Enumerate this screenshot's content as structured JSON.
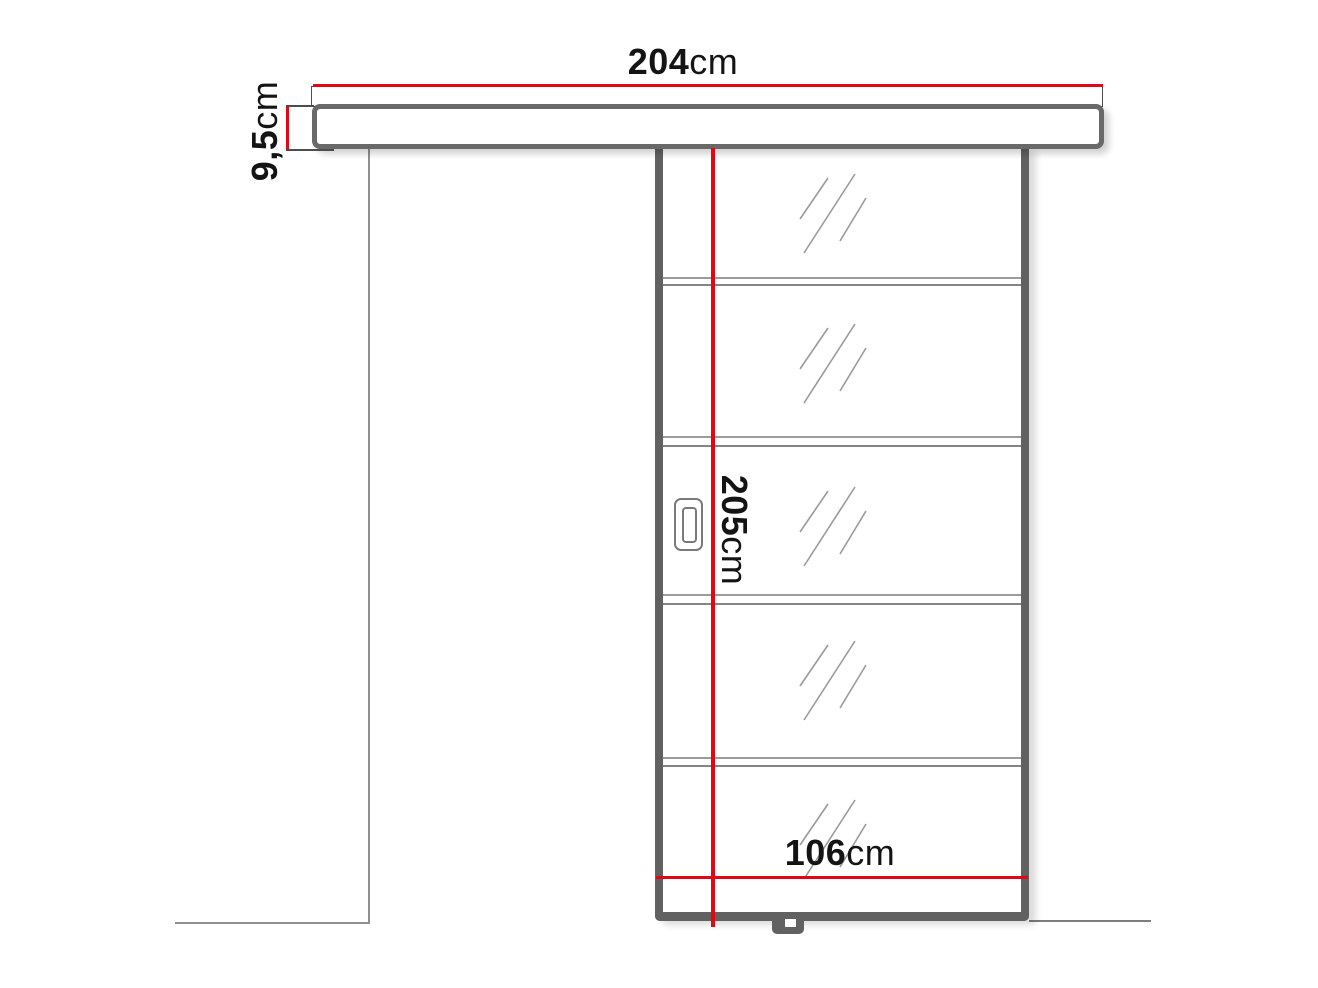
{
  "diagram": {
    "type": "sliding-door-technical-drawing",
    "dimensions": {
      "track_width": {
        "value": "204",
        "unit": "cm"
      },
      "track_height": {
        "value": "9,5",
        "unit": "cm"
      },
      "door_height": {
        "value": "205",
        "unit": "cm"
      },
      "door_width": {
        "value": "106",
        "unit": "cm"
      }
    },
    "components": {
      "top_track": "wall-mounted sliding track",
      "door_panel": "sliding door panel",
      "glass_section_count": 5,
      "divider_count": 4,
      "handle": "recessed vertical handle",
      "floor_guide": "bottom floor guide",
      "wall_line": "wall reference line",
      "floor_line": "floor reference line"
    },
    "colors": {
      "dimension_line_red": "#e30613",
      "frame_gray": "#616161",
      "rail_border_gray": "#696969",
      "detail_line_gray": "#9a9a9a",
      "label_text_black": "#141414",
      "background": "#ffffff"
    }
  }
}
